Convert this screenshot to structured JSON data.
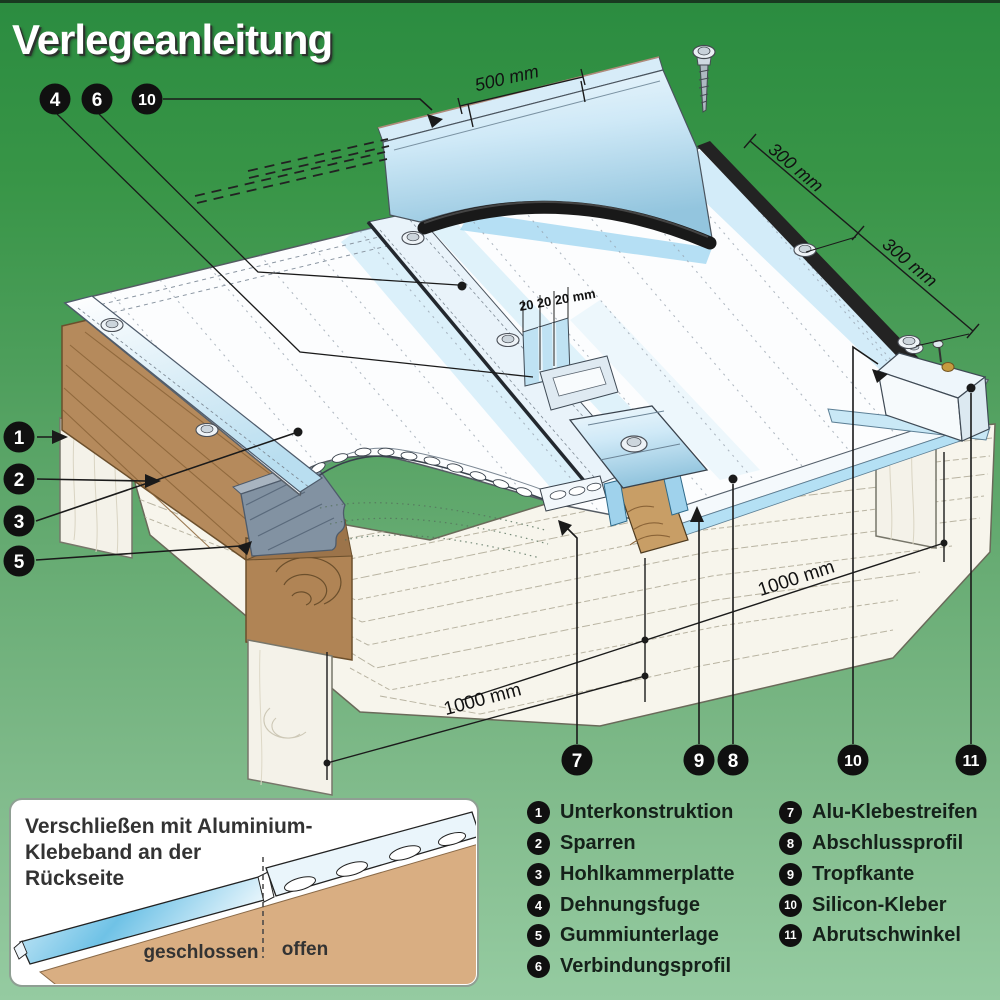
{
  "title": "Verlegeanleitung",
  "dimensions": {
    "d500": "500 mm",
    "d300a": "300 mm",
    "d300b": "300 mm",
    "d20": "20 20 20 mm",
    "d1000_left": "1000 mm",
    "d1000_right": "1000 mm"
  },
  "callouts": {
    "top": [
      {
        "n": "4"
      },
      {
        "n": "6"
      },
      {
        "n": "10"
      }
    ],
    "left": [
      {
        "n": "1"
      },
      {
        "n": "2"
      },
      {
        "n": "3"
      },
      {
        "n": "5"
      }
    ],
    "bottom": [
      {
        "n": "7"
      },
      {
        "n": "9"
      },
      {
        "n": "8"
      },
      {
        "n": "10"
      },
      {
        "n": "11"
      }
    ]
  },
  "inset": {
    "note": [
      "Verschließen mit Aluminium-",
      "Klebeband an der",
      "Rückseite"
    ],
    "closed_label": "geschlossen",
    "open_label": "offen"
  },
  "legend": {
    "col1": [
      {
        "num": "1",
        "label": "Unterkonstruktion"
      },
      {
        "num": "2",
        "label": "Sparren"
      },
      {
        "num": "3",
        "label": "Hohlkammerplatte"
      },
      {
        "num": "4",
        "label": "Dehnungsfuge"
      },
      {
        "num": "5",
        "label": "Gummiunterlage"
      },
      {
        "num": "6",
        "label": "Verbindungsprofil"
      }
    ],
    "col2": [
      {
        "num": "7",
        "label": "Alu-Klebestreifen"
      },
      {
        "num": "8",
        "label": "Abschlussprofil"
      },
      {
        "num": "9",
        "label": "Tropfkante"
      },
      {
        "num": "10",
        "label": "Silicon-Kleber"
      },
      {
        "num": "11",
        "label": "Abrutschwinkel"
      }
    ]
  },
  "colors": {
    "background_green_top": "#2b8c40",
    "background_green_bottom": "#95cba1",
    "panel_blue": "#aadcf4",
    "wood_brown": "#b58a5c",
    "line": "#1a1a1a"
  }
}
